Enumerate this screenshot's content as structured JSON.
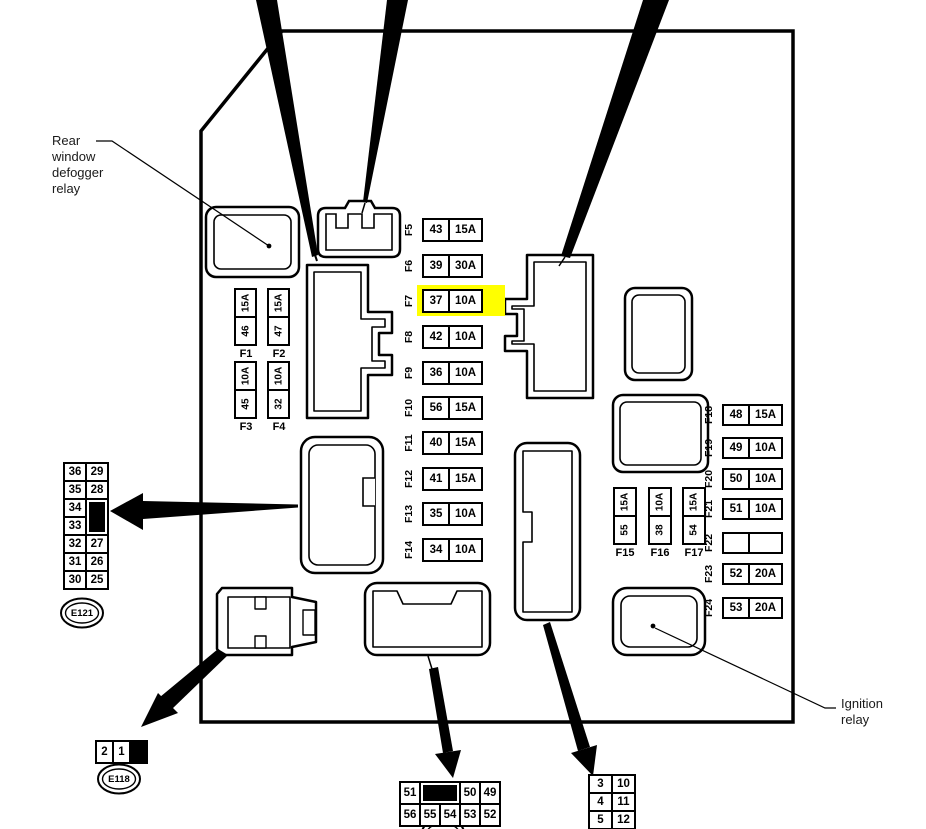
{
  "diagram": {
    "highlight_color": "#ffff00",
    "callouts": {
      "rear_window_defogger_relay": "Rear\nwindow\ndefogger\nrelay",
      "ignition_relay": "Ignition\nrelay"
    },
    "fuses": {
      "middle_column": [
        {
          "label": "F5",
          "number": "43",
          "amperage": "15A"
        },
        {
          "label": "F6",
          "number": "39",
          "amperage": "30A"
        },
        {
          "label": "F7",
          "number": "37",
          "amperage": "10A",
          "highlighted": true
        },
        {
          "label": "F8",
          "number": "42",
          "amperage": "10A"
        },
        {
          "label": "F9",
          "number": "36",
          "amperage": "10A"
        },
        {
          "label": "F10",
          "number": "56",
          "amperage": "15A"
        },
        {
          "label": "F11",
          "number": "40",
          "amperage": "15A"
        },
        {
          "label": "F12",
          "number": "41",
          "amperage": "15A"
        },
        {
          "label": "F13",
          "number": "35",
          "amperage": "10A"
        },
        {
          "label": "F14",
          "number": "34",
          "amperage": "10A"
        }
      ],
      "right_column": [
        {
          "label": "F18",
          "number": "48",
          "amperage": "15A"
        },
        {
          "label": "F19",
          "number": "49",
          "amperage": "10A"
        },
        {
          "label": "F20",
          "number": "50",
          "amperage": "10A"
        },
        {
          "label": "F21",
          "number": "51",
          "amperage": "10A"
        },
        {
          "label": "F22",
          "number": "",
          "amperage": ""
        },
        {
          "label": "F23",
          "number": "52",
          "amperage": "20A"
        },
        {
          "label": "F24",
          "number": "53",
          "amperage": "20A"
        }
      ],
      "upper_left_block": [
        {
          "label": "F1",
          "number": "46",
          "amperage": "15A"
        },
        {
          "label": "F2",
          "number": "47",
          "amperage": "15A"
        },
        {
          "label": "F3",
          "number": "45",
          "amperage": "10A"
        },
        {
          "label": "F4",
          "number": "32",
          "amperage": "10A"
        }
      ],
      "lower_middle_block": [
        {
          "label": "F15",
          "number": "55",
          "amperage": "15A"
        },
        {
          "label": "F16",
          "number": "38",
          "amperage": "10A"
        },
        {
          "label": "F17",
          "number": "54",
          "amperage": "15A"
        }
      ]
    },
    "connectors": {
      "left_pin_grid": {
        "left_column": [
          "36",
          "35",
          "34",
          "33",
          "32",
          "31",
          "30"
        ],
        "right_column_top": [
          "29",
          "28"
        ],
        "right_column_bottom": [
          "27",
          "26",
          "25"
        ],
        "oval_label": "E121"
      },
      "bottom_left_pins": {
        "cells": [
          "2",
          "1"
        ],
        "oval_label": "E118"
      },
      "bottom_middle_pin_grid": {
        "row1": [
          "51",
          "50",
          "49"
        ],
        "row2": [
          "56",
          "55",
          "54",
          "53",
          "52"
        ]
      },
      "bottom_right_pin_grid": {
        "rows": [
          [
            "3",
            "10"
          ],
          [
            "4",
            "11"
          ],
          [
            "5",
            "12"
          ]
        ]
      }
    }
  }
}
